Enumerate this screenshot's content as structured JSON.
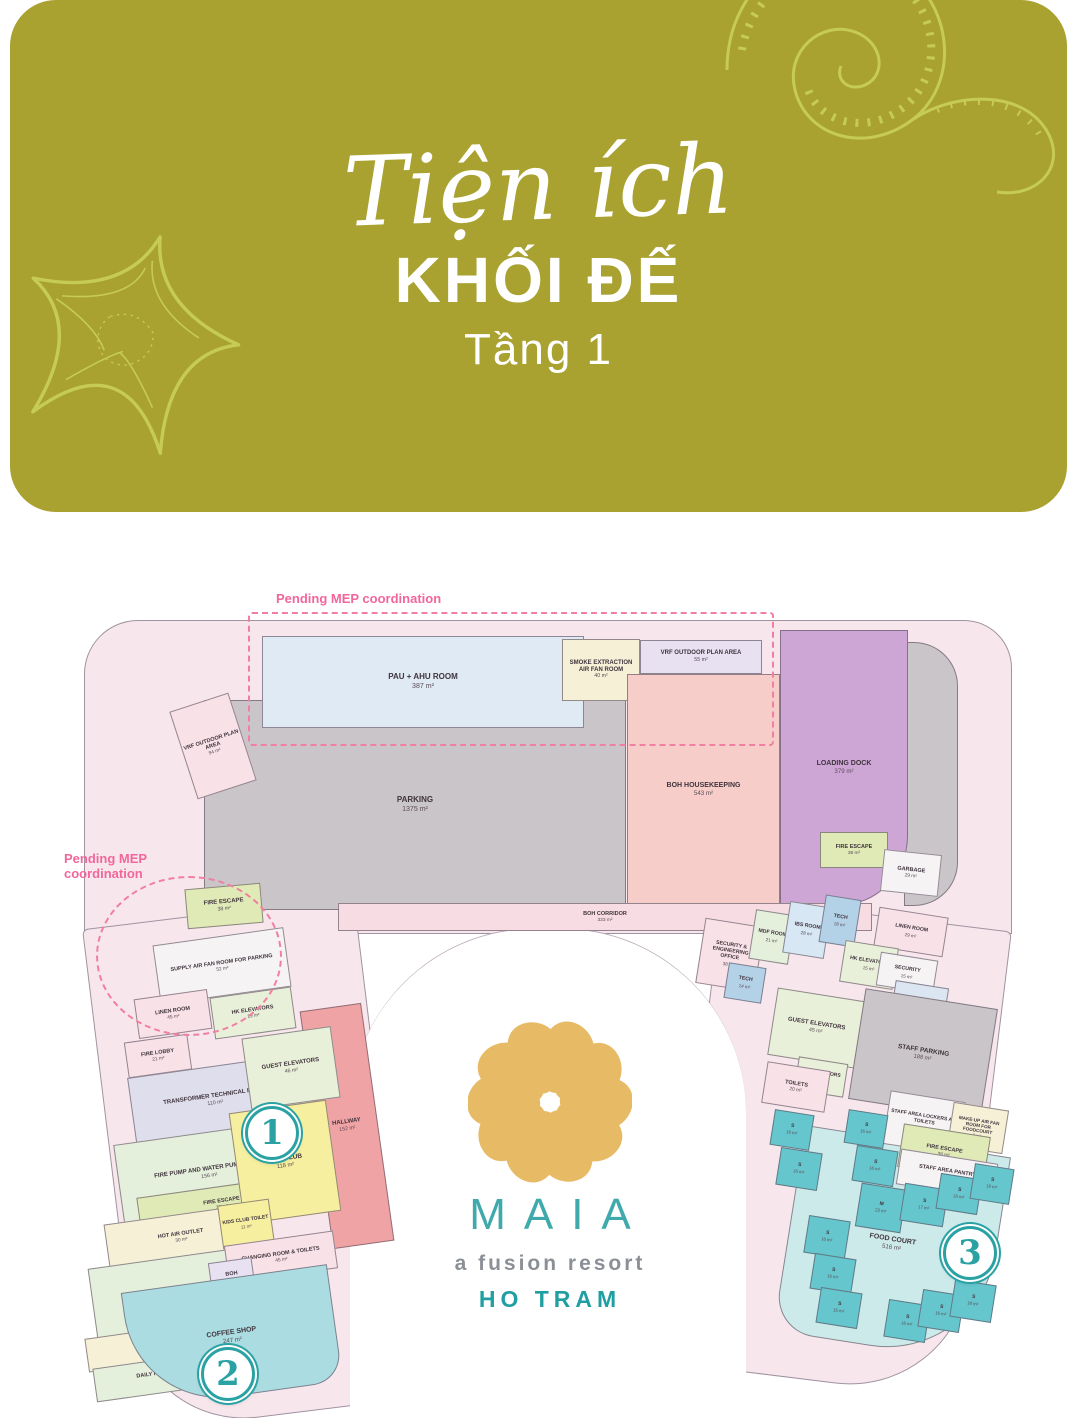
{
  "banner": {
    "title_script": "Tiện ích",
    "title_main": "KHỐI ĐẾ",
    "subtitle": "Tầng 1",
    "bg_color": "#a9a230",
    "art_color": "#c6cb57"
  },
  "logo": {
    "name": "MAIA",
    "tagline": "a fusion resort",
    "location": "HO TRAM",
    "flower_color": "#e7ba66",
    "name_color": "#3fa9ab",
    "tagline_color": "#8b9096",
    "location_color": "#1f9fa2"
  },
  "annotations": {
    "pending_mep": "Pending MEP coordination",
    "color": "#f2679b",
    "notes": [
      {
        "x": 276,
        "y": 592,
        "text": "Pending MEP coordination"
      },
      {
        "x": 64,
        "y": 852,
        "text": "Pending MEP\ncoordination"
      }
    ]
  },
  "marker_color": "#2aa2a4",
  "markers": [
    {
      "label": "1",
      "x": 272,
      "y": 1133
    },
    {
      "label": "2",
      "x": 228,
      "y": 1374
    },
    {
      "label": "3",
      "x": 970,
      "y": 1253
    }
  ],
  "palette": {
    "base": "#f7e7ec",
    "gray": "#cac5c8",
    "blue_room": "#dfeaf4",
    "cream": "#f6f0d7",
    "lav": "#e7e1f1",
    "boh_pink": "#f6cdc8",
    "purple": "#cda6d6",
    "corridor": "#f7dde3",
    "green": "#dfeab7",
    "salmon": "#f0a3a4",
    "elev": "#e9f0d9",
    "yellow": "#f5ef9f",
    "pinkroom": "#f8e2e8",
    "teal_lt": "#abdce1",
    "teal_md": "#cdeaea",
    "stall": "#66c6ce",
    "tlav": "#dfdeed",
    "pgreen": "#e4efdc",
    "tech": "#b3d2e8",
    "ibs": "#d7e7f3",
    "white": "#f6f3f5",
    "lblue": "#dce6f2"
  },
  "rooms": [
    {
      "l": "",
      "a": "",
      "x": 904,
      "y": 642,
      "w": 54,
      "h": 264,
      "c": "gray",
      "rd": "0 44px 44px 0"
    },
    {
      "l": "PARKING",
      "a": "1375 m²",
      "x": 204,
      "y": 700,
      "w": 422,
      "h": 210,
      "c": "gray",
      "fs": 8
    },
    {
      "l": "PAU + AHU ROOM",
      "a": "387 m²",
      "x": 262,
      "y": 636,
      "w": 322,
      "h": 92,
      "c": "blue_room",
      "fs": 8
    },
    {
      "l": "SMOKE EXTRACTION AIR FAN ROOM",
      "a": "40 m²",
      "x": 562,
      "y": 639,
      "w": 78,
      "h": 62,
      "c": "cream",
      "fs": 6
    },
    {
      "l": "VRF OUTDOOR PLAN AREA",
      "a": "55 m²",
      "x": 640,
      "y": 640,
      "w": 122,
      "h": 34,
      "c": "lav",
      "fs": 6
    },
    {
      "l": "BOH HOUSEKEEPING",
      "a": "543 m²",
      "x": 627,
      "y": 674,
      "w": 153,
      "h": 232,
      "c": "boh_pink",
      "fs": 7
    },
    {
      "l": "LOADING DOCK",
      "a": "379 m²",
      "x": 780,
      "y": 630,
      "w": 128,
      "h": 276,
      "c": "purple",
      "fs": 7,
      "rd": "0 0 70px 0"
    },
    {
      "l": "VRF OUTDOOR PLAN AREA",
      "a": "94 m²",
      "x": 182,
      "y": 700,
      "w": 62,
      "h": 92,
      "c": "pinkroom",
      "r": -18,
      "fs": 5.5
    },
    {
      "l": "FIRE ESCAPE",
      "a": "38 m²",
      "x": 186,
      "y": 886,
      "w": 76,
      "h": 40,
      "c": "green",
      "r": -5,
      "fs": 6
    },
    {
      "l": "FIRE ESCAPE",
      "a": "38 m²",
      "x": 820,
      "y": 832,
      "w": 68,
      "h": 36,
      "c": "green",
      "fs": 5.5
    },
    {
      "l": "GARBAGE",
      "a": "29 m²",
      "x": 882,
      "y": 852,
      "w": 58,
      "h": 42,
      "c": "white",
      "r": 6,
      "fs": 5.5
    },
    {
      "l": "BOH CORRIDOR",
      "a": "333 m²",
      "x": 338,
      "y": 903,
      "w": 534,
      "h": 28,
      "c": "corridor",
      "fs": 5.5
    },
    {
      "l": "SECURITY & ENGINEERING OFFICE",
      "a": "38 m²",
      "x": 700,
      "y": 922,
      "w": 60,
      "h": 66,
      "c": "pinkroom",
      "r": 9,
      "fs": 5.2
    },
    {
      "l": "MDF ROOM",
      "a": "21 m²",
      "x": 752,
      "y": 912,
      "w": 40,
      "h": 50,
      "c": "pgreen",
      "r": 9,
      "fs": 5.2
    },
    {
      "l": "IBS ROOM",
      "a": "28 m²",
      "x": 786,
      "y": 904,
      "w": 42,
      "h": 52,
      "c": "ibs",
      "r": 9,
      "fs": 5.2
    },
    {
      "l": "TECH",
      "a": "18 m²",
      "x": 822,
      "y": 897,
      "w": 36,
      "h": 48,
      "c": "tech",
      "r": 9,
      "fs": 5.2
    },
    {
      "l": "TECH",
      "a": "14 m²",
      "x": 726,
      "y": 965,
      "w": 38,
      "h": 36,
      "c": "tech",
      "r": 9,
      "fs": 5.2
    },
    {
      "l": "LINEN ROOM",
      "a": "29 m²",
      "x": 876,
      "y": 912,
      "w": 70,
      "h": 40,
      "c": "pinkroom",
      "r": 9,
      "fs": 5.2
    },
    {
      "l": "HK ELEVATORS",
      "a": "15 m²",
      "x": 842,
      "y": 944,
      "w": 54,
      "h": 42,
      "c": "elev",
      "r": 9,
      "fs": 5.2
    },
    {
      "l": "SECURITY",
      "a": "15 m²",
      "x": 878,
      "y": 956,
      "w": 58,
      "h": 34,
      "c": "white",
      "r": 9,
      "fs": 5.2
    },
    {
      "l": "FIRE LOBBY",
      "a": "9 m²",
      "x": 892,
      "y": 984,
      "w": 54,
      "h": 44,
      "c": "lblue",
      "r": 9,
      "fs": 5.2
    },
    {
      "l": "GUEST ELEVATORS",
      "a": "45 m²",
      "x": 772,
      "y": 994,
      "w": 88,
      "h": 68,
      "c": "elev",
      "r": 9,
      "fs": 6
    },
    {
      "l": "STAFF PARKING",
      "a": "188 m²",
      "x": 856,
      "y": 998,
      "w": 134,
      "h": 112,
      "c": "gray",
      "r": 9,
      "fs": 6.5
    },
    {
      "l": "FOOD COURT",
      "a": "516 m²",
      "x": 788,
      "y": 1140,
      "w": 208,
      "h": 208,
      "c": "teal_md",
      "r": 9,
      "fs": 7,
      "rd": "0 0 110px 40px"
    },
    {
      "l": "HK ELEVATORS",
      "a": "7 m²",
      "x": 796,
      "y": 1060,
      "w": 50,
      "h": 34,
      "c": "elev",
      "r": 9,
      "fs": 5
    },
    {
      "l": "TOILETS",
      "a": "20 m²",
      "x": 764,
      "y": 1066,
      "w": 64,
      "h": 42,
      "c": "pinkroom",
      "r": 9,
      "fs": 5.5
    },
    {
      "l": "STAFF AREA LOCKERS AND TOILETS",
      "a": "39 m²",
      "x": 886,
      "y": 1096,
      "w": 76,
      "h": 54,
      "c": "white",
      "r": 9,
      "fs": 5
    },
    {
      "l": "MAKE-UP AIR FAN ROOM FOR FOODCOURT",
      "a": "9 m²",
      "x": 950,
      "y": 1106,
      "w": 56,
      "h": 44,
      "c": "cream",
      "r": 9,
      "fs": 4.6
    },
    {
      "l": "FIRE ESCAPE",
      "a": "38 m²",
      "x": 900,
      "y": 1130,
      "w": 88,
      "h": 44,
      "c": "green",
      "r": 9,
      "fs": 5.5
    },
    {
      "l": "STAFF AREA PANTRY",
      "a": "37 m²",
      "x": 898,
      "y": 1156,
      "w": 98,
      "h": 36,
      "c": "white",
      "r": 9,
      "fs": 5.5
    },
    {
      "l": "S",
      "a": "16 m²",
      "x": 772,
      "y": 1112,
      "w": 40,
      "h": 36,
      "c": "stall",
      "r": 9,
      "fs": 5
    },
    {
      "l": "S",
      "a": "16 m²",
      "x": 778,
      "y": 1150,
      "w": 42,
      "h": 38,
      "c": "stall",
      "r": 9,
      "fs": 5
    },
    {
      "l": "S",
      "a": "16 m²",
      "x": 806,
      "y": 1218,
      "w": 42,
      "h": 38,
      "c": "stall",
      "r": 9,
      "fs": 5
    },
    {
      "l": "S",
      "a": "16 m²",
      "x": 812,
      "y": 1256,
      "w": 42,
      "h": 36,
      "c": "stall",
      "r": 9,
      "fs": 5
    },
    {
      "l": "S",
      "a": "15 m²",
      "x": 818,
      "y": 1290,
      "w": 42,
      "h": 36,
      "c": "stall",
      "r": 9,
      "fs": 5
    },
    {
      "l": "S",
      "a": "16 m²",
      "x": 846,
      "y": 1112,
      "w": 40,
      "h": 34,
      "c": "stall",
      "r": 9,
      "fs": 5
    },
    {
      "l": "S",
      "a": "16 m²",
      "x": 854,
      "y": 1148,
      "w": 42,
      "h": 36,
      "c": "stall",
      "r": 9,
      "fs": 5
    },
    {
      "l": "M",
      "a": "23 m²",
      "x": 858,
      "y": 1186,
      "w": 46,
      "h": 44,
      "c": "stall",
      "r": 9,
      "fs": 5
    },
    {
      "l": "S",
      "a": "17 m²",
      "x": 902,
      "y": 1186,
      "w": 44,
      "h": 38,
      "c": "stall",
      "r": 9,
      "fs": 5
    },
    {
      "l": "S",
      "a": "16 m²",
      "x": 938,
      "y": 1176,
      "w": 42,
      "h": 36,
      "c": "stall",
      "r": 9,
      "fs": 5
    },
    {
      "l": "S",
      "a": "19 m²",
      "x": 972,
      "y": 1166,
      "w": 40,
      "h": 36,
      "c": "stall",
      "r": 9,
      "fs": 5
    },
    {
      "l": "S",
      "a": "16 m²",
      "x": 886,
      "y": 1302,
      "w": 42,
      "h": 38,
      "c": "stall",
      "r": 9,
      "fs": 5
    },
    {
      "l": "S",
      "a": "16 m²",
      "x": 920,
      "y": 1292,
      "w": 42,
      "h": 38,
      "c": "stall",
      "r": 9,
      "fs": 5
    },
    {
      "l": "S",
      "a": "18 m²",
      "x": 952,
      "y": 1282,
      "w": 42,
      "h": 38,
      "c": "stall",
      "r": 9,
      "fs": 5
    },
    {
      "l": "SUPPLY AIR FAN ROOM FOR PARKING",
      "a": "52 m²",
      "x": 156,
      "y": 936,
      "w": 132,
      "h": 60,
      "c": "white",
      "r": -8,
      "fs": 5.5
    },
    {
      "l": "LINEN ROOM",
      "a": "45 m²",
      "x": 136,
      "y": 994,
      "w": 74,
      "h": 40,
      "c": "pinkroom",
      "r": -8,
      "fs": 5.5
    },
    {
      "l": "HK ELEVATORS",
      "a": "19 m²",
      "x": 212,
      "y": 992,
      "w": 82,
      "h": 42,
      "c": "elev",
      "r": -8,
      "fs": 5.5
    },
    {
      "l": "FIRE LOBBY",
      "a": "21 m²",
      "x": 126,
      "y": 1038,
      "w": 64,
      "h": 36,
      "c": "pinkroom",
      "r": -8,
      "fs": 5.5
    },
    {
      "l": "TRANSFORMER TECHNICAL ROOM",
      "a": "110 m²",
      "x": 131,
      "y": 1066,
      "w": 168,
      "h": 68,
      "c": "tlav",
      "r": -8,
      "fs": 6
    },
    {
      "l": "FIRE PUMP AND WATER PUMP ROOM",
      "a": "156 m²",
      "x": 118,
      "y": 1132,
      "w": 182,
      "h": 82,
      "c": "pgreen",
      "r": -8,
      "fs": 6
    },
    {
      "l": "FIRE ESCAPE",
      "a": "38 m²",
      "x": 138,
      "y": 1186,
      "w": 168,
      "h": 36,
      "c": "green",
      "r": -8,
      "fs": 5.5
    },
    {
      "l": "HOT AIR OUTLET",
      "a": "30 m²",
      "x": 106,
      "y": 1214,
      "w": 150,
      "h": 46,
      "c": "cream",
      "r": -8,
      "fs": 5.5
    },
    {
      "l": "AIR INLET SILENCER",
      "a": "122 m²",
      "x": 92,
      "y": 1256,
      "w": 180,
      "h": 76,
      "c": "pgreen",
      "r": -8,
      "fs": 6
    },
    {
      "l": "AIR INLET CHAMBER",
      "a": "24 m²",
      "x": 86,
      "y": 1328,
      "w": 154,
      "h": 34,
      "c": "cream",
      "r": -8,
      "fs": 5.5
    },
    {
      "l": "DAILY FUEL TANK ROOM",
      "a": "14 m²",
      "x": 94,
      "y": 1358,
      "w": 152,
      "h": 34,
      "c": "pgreen",
      "r": -8,
      "fs": 5.5
    },
    {
      "l": "HALLWAY",
      "a": "152 m²",
      "x": 316,
      "y": 1006,
      "w": 62,
      "h": 240,
      "c": "salmon",
      "r": -8,
      "fs": 6
    },
    {
      "l": "GUEST ELEVATORS",
      "a": "46 m²",
      "x": 246,
      "y": 1032,
      "w": 90,
      "h": 72,
      "c": "elev",
      "r": -8,
      "fs": 6
    },
    {
      "l": "KIDS CLUB",
      "a": "118 m²",
      "x": 236,
      "y": 1106,
      "w": 98,
      "h": 112,
      "c": "yellow",
      "r": -8,
      "fs": 6.5
    },
    {
      "l": "KIDS CLUB TOILET",
      "a": "11 m²",
      "x": 220,
      "y": 1202,
      "w": 52,
      "h": 44,
      "c": "yellow",
      "r": -8,
      "fs": 5
    },
    {
      "l": "CHANGING ROOM & TOILETS",
      "a": "45 m²",
      "x": 226,
      "y": 1238,
      "w": 110,
      "h": 38,
      "c": "pinkroom",
      "r": -8,
      "fs": 5.5
    },
    {
      "l": "BOH",
      "a": "11 m²",
      "x": 210,
      "y": 1260,
      "w": 44,
      "h": 34,
      "c": "lav",
      "r": -8,
      "fs": 5.5
    },
    {
      "l": "COFFEE SHOP",
      "a": "247 m²",
      "x": 128,
      "y": 1278,
      "w": 208,
      "h": 118,
      "c": "teal_lt",
      "r": -8,
      "fs": 7,
      "rd": "0 0 30px 95px"
    }
  ]
}
